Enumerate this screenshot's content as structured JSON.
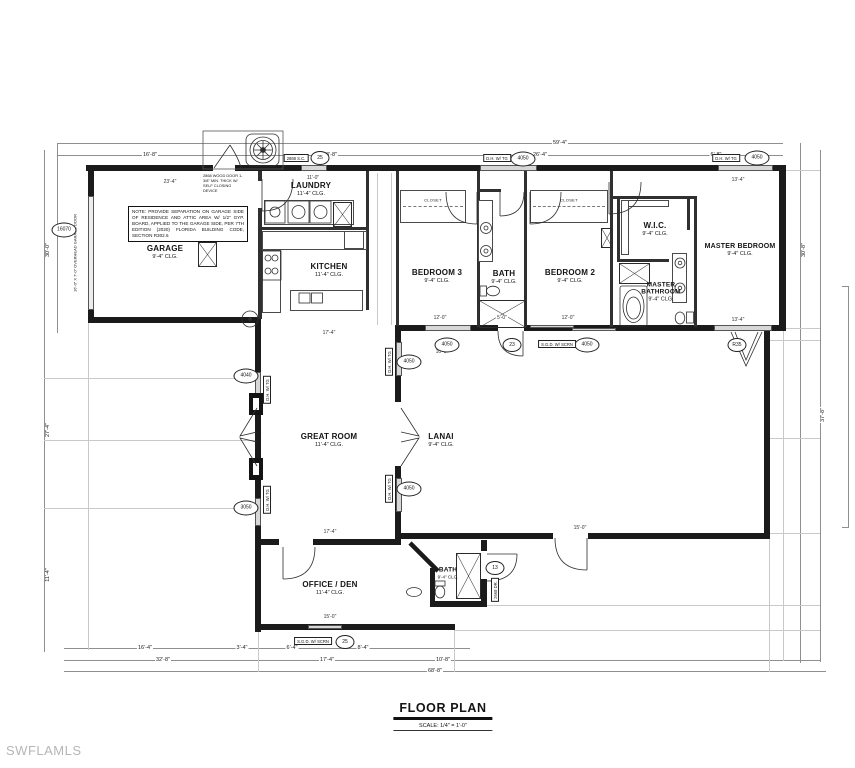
{
  "watermark": "SWFLAMLS",
  "title_block": {
    "title": "FLOOR PLAN",
    "scale": "SCALE:  1/4\" = 1'-0\""
  },
  "garage_note": "NOTE: PROVIDE SEPARATION ON GARAGE SIDE OF RESIDENCE AND ATTIC AREA W/ 1/2\" GYP. BOARD, APPLIED TO THE GARAGE SIDE, PER 7TH EDITION (2020) FLORIDA BUILDING CODE, SECTION R302.6",
  "door_note": "2868 WOOD DOOR 1-3/8\" MIN. THICK W/ SELF CLOSING DEVICE",
  "garage_door_note": "16'-0\" X 7'-0\" OVERHEAD GARAGE DOOR",
  "closet_label": "CLOSET",
  "rooms": [
    {
      "name": "GARAGE",
      "clg": "9'-4\" CLG."
    },
    {
      "name": "LAUNDRY",
      "clg": "11'-4\" CLG."
    },
    {
      "name": "KITCHEN",
      "clg": "11'-4\" CLG."
    },
    {
      "name": "BEDROOM 3",
      "clg": "9'-4\" CLG."
    },
    {
      "name": "BATH",
      "clg": "9'-4\" CLG."
    },
    {
      "name": "BEDROOM 2",
      "clg": "9'-4\" CLG."
    },
    {
      "name": "W.I.C.",
      "clg": "9'-4\" CLG."
    },
    {
      "name": "MASTER BEDROOM",
      "clg": "9'-4\" CLG."
    },
    {
      "name": "MASTER BATHROOM",
      "clg": "9'-4\" CLG."
    },
    {
      "name": "GREAT ROOM",
      "clg": "11'-4\" CLG."
    },
    {
      "name": "LANAI",
      "clg": "9'-4\" CLG."
    },
    {
      "name": "OFFICE / DEN",
      "clg": "11'-4\" CLG."
    },
    {
      "name": "BATH",
      "clg": "9'-4\" CLG."
    }
  ],
  "tags": [
    "25",
    "4050",
    "4050",
    "4050",
    "23",
    "4050",
    "R35",
    "4040",
    "3050",
    "4050",
    "4050",
    "13",
    "25",
    "16070"
  ],
  "window_boxes": [
    "D.H. W/ TG",
    "D.H. W/ TG",
    "S.G.D. W/ SCRN",
    "2868 S.C.",
    "S.G.D. W/ SCRN",
    "D.H. W/ TG",
    "D.H. W/ TG",
    "D.H. W/ TG",
    "D.H. W/ TG",
    "2668 DR."
  ],
  "dims": {
    "overall_top": "59'-4\"",
    "top": [
      "16'-8\"",
      "23'-8\"",
      "26'-4\"",
      "6'-8\""
    ],
    "bottom_row1": [
      "16'-4\"",
      "3'-4\"",
      "6'-4\"",
      "8'-4\""
    ],
    "bottom_row2": [
      "32'-8\"",
      "17'-4\"",
      "10'-8\""
    ],
    "overall_bottom": "68'-8\"",
    "left": [
      "30'-0\"",
      "27'-4\"",
      "11'-4\""
    ],
    "right": [
      "30'-8\"",
      "37'-8\""
    ],
    "inner": [
      "23'-4\"",
      "11'-0\"",
      "17'-4\"",
      "12'-0\"",
      "5'-0\"",
      "12'-0\"",
      "13'-4\"",
      "13'-4\"",
      "17'-4\"",
      "15'-0\"",
      "15'-0\"",
      "10'-8\""
    ]
  }
}
